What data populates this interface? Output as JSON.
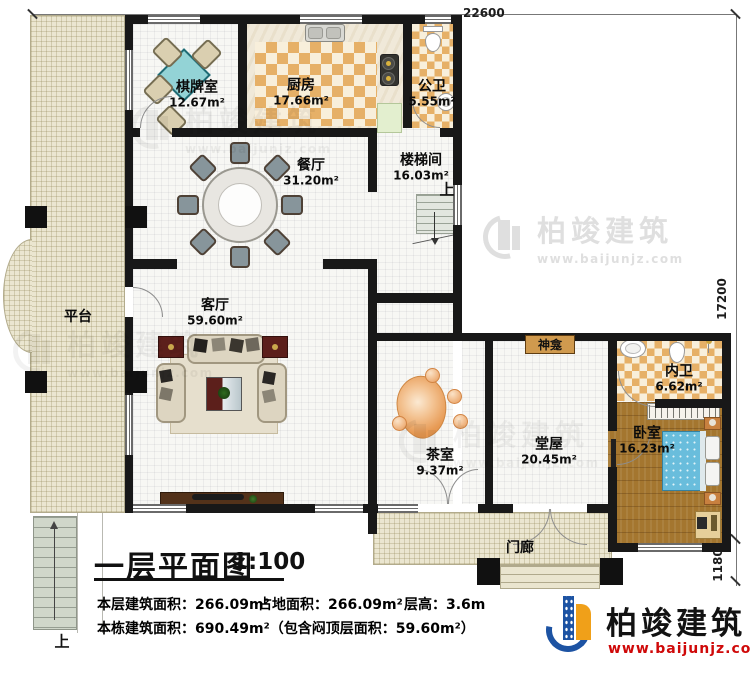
{
  "title": {
    "name": "一层平面图",
    "scale": "1:100"
  },
  "dimensions": {
    "top": "22600",
    "right": "17200",
    "right_lower": "1180"
  },
  "rooms": {
    "platform": {
      "name": "平台"
    },
    "chess_room": {
      "name": "棋牌室",
      "area": "12.67m²"
    },
    "kitchen": {
      "name": "厨房",
      "area": "17.66m²"
    },
    "public_bath": {
      "name": "公卫",
      "area": "5.55m²"
    },
    "dining_room": {
      "name": "餐厅",
      "area": "31.20m²"
    },
    "stair_hall": {
      "name": "楼梯间",
      "area": "16.03m²"
    },
    "living_room": {
      "name": "客厅",
      "area": "59.60m²"
    },
    "tea_room": {
      "name": "茶室",
      "area": "9.37m²"
    },
    "main_hall": {
      "name": "堂屋",
      "area": "20.45m²"
    },
    "shrine": {
      "name": "神龛"
    },
    "inner_bath": {
      "name": "内卫",
      "area": "6.62m²"
    },
    "bedroom": {
      "name": "卧室",
      "area": "16.23m²"
    },
    "porch": {
      "name": "门廊"
    }
  },
  "labels": {
    "up": "上"
  },
  "info": {
    "floor_area": "本层建筑面积：266.09m²",
    "land_area": "占地面积：266.09m²",
    "floor_height": "层高：3.6m",
    "total_area": "本栋建筑面积：690.49m²（包含闷顶层面积：59.60m²）"
  },
  "brand": {
    "name": "柏竣建筑",
    "url": "www.baijunjz.com"
  },
  "colors": {
    "wall": "#181818",
    "accent_blue": "#1d53a3",
    "accent_orange": "#f0a019",
    "url_red": "#cf0909"
  }
}
